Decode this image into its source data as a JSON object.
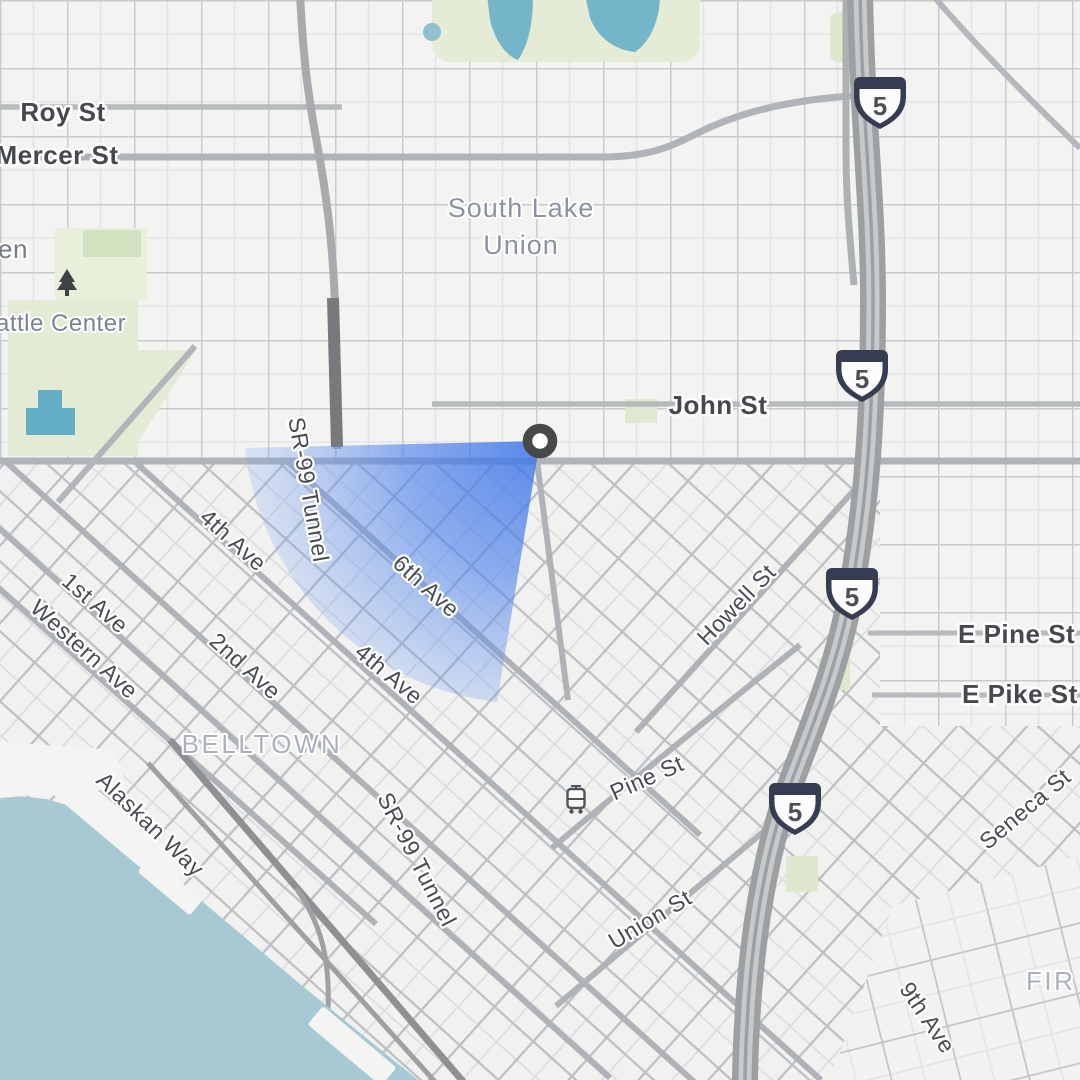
{
  "map": {
    "marker": {
      "type": "location-marker",
      "ring_color": "#46484a",
      "fill": "#ffffff"
    },
    "view_cone": {
      "color": "#4285f4",
      "direction": "west-southwest"
    },
    "shield": {
      "route": "5",
      "count": 4,
      "outline_color": "#363c52"
    },
    "neighborhoods": {
      "south_lake_union_line1": "South Lake",
      "south_lake_union_line2": "Union",
      "belltown": "BELLTOWN",
      "first_hill_partial": "FIR",
      "seattle_center_partial": "attle Center",
      "garden_partial": "en"
    },
    "streets": {
      "roy": "Roy St",
      "mercer": "Mercer St",
      "john": "John St",
      "sr99_tunnel": "SR-99 Tunnel",
      "first_ave": "1st Ave",
      "second_ave": "2nd Ave",
      "fourth_ave": "4th Ave",
      "sixth_ave": "6th Ave",
      "ninth_ave": "9th Ave",
      "western_ave": "Western Ave",
      "alaskan_way": "Alaskan Way",
      "howell": "Howell St",
      "pine": "Pine St",
      "union": "Union St",
      "seneca": "Seneca St",
      "e_pine": "E Pine St",
      "e_pike": "E Pike St"
    },
    "colors": {
      "water": "#a6c9d3",
      "lake": "#74b5c9",
      "park": "#e3ebd5",
      "land": "#f3f3f2",
      "minor_road": "#c8cbce",
      "major_road": "#b0b3b7",
      "freeway": "#9da0a3",
      "street_label": "#474c52",
      "neighborhood_label": "#8b93a3",
      "district_label": "#abb0bf",
      "cone_blue": "#4285f4"
    }
  }
}
